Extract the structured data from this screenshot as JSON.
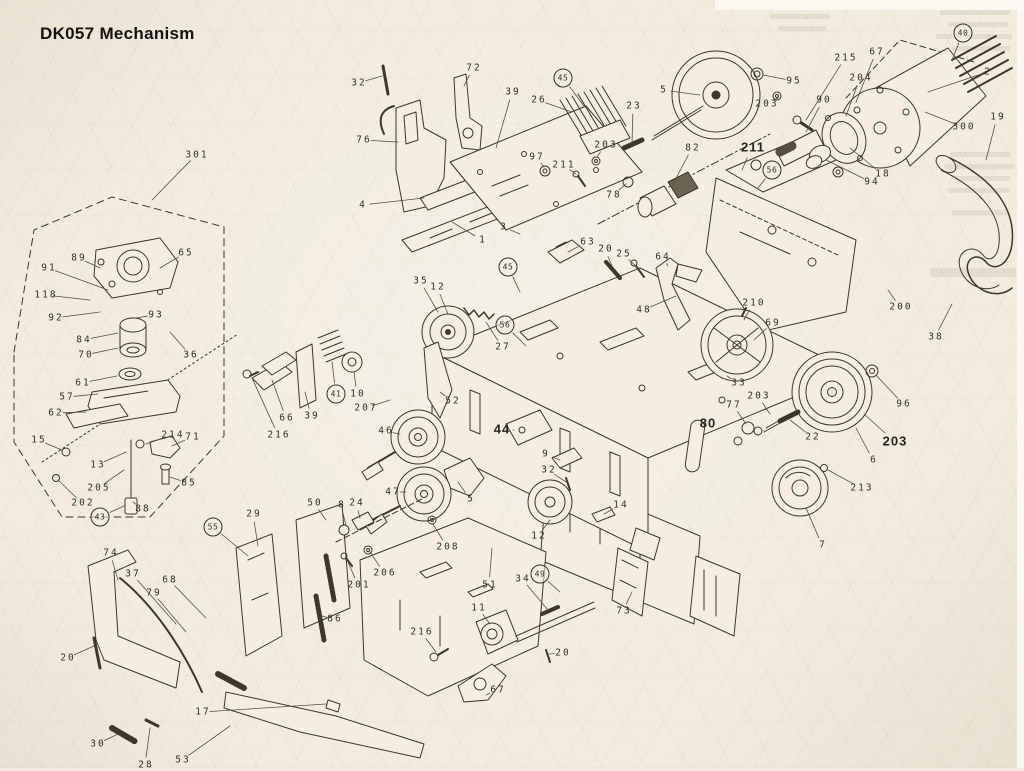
{
  "page": {
    "title": "DK057 Mechanism",
    "background": "#f2ecdf",
    "ink": "#3a342b"
  },
  "diagram": {
    "description": "Exploded parts view of the DK057 tape mechanism with numbered callouts",
    "callouts": [
      {
        "label": "301",
        "x": 196,
        "y": 155,
        "leader": [
          152,
          200
        ]
      },
      {
        "label": "89",
        "x": 78,
        "y": 258,
        "leader": [
          100,
          268
        ]
      },
      {
        "label": "65",
        "x": 185,
        "y": 253,
        "leader": [
          160,
          268
        ]
      },
      {
        "label": "91",
        "x": 48,
        "y": 268,
        "leader": [
          108,
          290
        ]
      },
      {
        "label": "118",
        "x": 45,
        "y": 295,
        "leader": [
          90,
          300
        ]
      },
      {
        "label": "92",
        "x": 55,
        "y": 318,
        "leader": [
          100,
          312
        ]
      },
      {
        "label": "93",
        "x": 155,
        "y": 315,
        "leader": [
          136,
          318
        ]
      },
      {
        "label": "36",
        "x": 190,
        "y": 355,
        "leader": [
          170,
          332
        ]
      },
      {
        "label": "84",
        "x": 83,
        "y": 340,
        "leader": [
          118,
          333
        ]
      },
      {
        "label": "70",
        "x": 85,
        "y": 355,
        "leader": [
          118,
          348
        ]
      },
      {
        "label": "61",
        "x": 82,
        "y": 383,
        "leader": [
          117,
          376
        ]
      },
      {
        "label": "57",
        "x": 66,
        "y": 397,
        "leader": [
          98,
          394
        ]
      },
      {
        "label": "62",
        "x": 55,
        "y": 413,
        "leader": [
          86,
          412
        ]
      },
      {
        "label": "15",
        "x": 38,
        "y": 440,
        "leader": [
          62,
          450
        ]
      },
      {
        "label": "214",
        "x": 172,
        "y": 435,
        "leader": [
          146,
          444
        ]
      },
      {
        "label": "71",
        "x": 192,
        "y": 437,
        "leader": [
          172,
          446
        ]
      },
      {
        "label": "13",
        "x": 97,
        "y": 465,
        "leader": [
          126,
          452
        ]
      },
      {
        "label": "205",
        "x": 98,
        "y": 488,
        "leader": [
          124,
          470
        ]
      },
      {
        "label": "85",
        "x": 188,
        "y": 483,
        "leader": [
          170,
          477
        ]
      },
      {
        "label": "202",
        "x": 82,
        "y": 503,
        "leader": [
          58,
          480
        ]
      },
      {
        "label": "43",
        "x": 100,
        "y": 517,
        "circled": true,
        "leader": [
          124,
          506
        ]
      },
      {
        "label": "88",
        "x": 142,
        "y": 509,
        "leader": [
          133,
          502
        ]
      },
      {
        "label": "74",
        "x": 110,
        "y": 553,
        "leader": [
          118,
          580
        ]
      },
      {
        "label": "37",
        "x": 132,
        "y": 574,
        "leader": [
          176,
          624
        ]
      },
      {
        "label": "79",
        "x": 153,
        "y": 593,
        "leader": [
          186,
          632
        ]
      },
      {
        "label": "68",
        "x": 169,
        "y": 580,
        "leader": [
          206,
          618
        ]
      },
      {
        "label": "20",
        "x": 67,
        "y": 658,
        "leader": [
          94,
          646
        ]
      },
      {
        "label": "30",
        "x": 97,
        "y": 744,
        "leader": [
          118,
          734
        ]
      },
      {
        "label": "28",
        "x": 145,
        "y": 765,
        "leader": [
          150,
          728
        ]
      },
      {
        "label": "53",
        "x": 182,
        "y": 760,
        "leader": [
          230,
          726
        ]
      },
      {
        "label": "17",
        "x": 202,
        "y": 712,
        "leader": [
          326,
          704
        ]
      },
      {
        "label": "55",
        "x": 213,
        "y": 527,
        "circled": true,
        "leader": [
          248,
          556
        ]
      },
      {
        "label": "29",
        "x": 253,
        "y": 514,
        "leader": [
          258,
          546
        ]
      },
      {
        "label": "50",
        "x": 314,
        "y": 503,
        "leader": [
          326,
          520
        ]
      },
      {
        "label": "66",
        "x": 286,
        "y": 418,
        "leader": [
          272,
          380
        ]
      },
      {
        "label": "39",
        "x": 311,
        "y": 416,
        "leader": [
          305,
          392
        ]
      },
      {
        "label": "216",
        "x": 278,
        "y": 435,
        "leader": [
          252,
          378
        ]
      },
      {
        "label": "41",
        "x": 336,
        "y": 394,
        "circled": true,
        "leader": [
          332,
          362
        ]
      },
      {
        "label": "10",
        "x": 357,
        "y": 394,
        "leader": [
          354,
          372
        ]
      },
      {
        "label": "207",
        "x": 365,
        "y": 408,
        "leader": [
          390,
          400
        ]
      },
      {
        "label": "86",
        "x": 334,
        "y": 619,
        "leader": [
          322,
          616
        ]
      },
      {
        "label": "201",
        "x": 358,
        "y": 585,
        "leader": [
          348,
          562
        ]
      },
      {
        "label": "206",
        "x": 384,
        "y": 573,
        "leader": [
          370,
          552
        ]
      },
      {
        "label": "8",
        "x": 341,
        "y": 505,
        "leader": [
          346,
          526
        ]
      },
      {
        "label": "24",
        "x": 356,
        "y": 503,
        "leader": [
          360,
          518
        ]
      },
      {
        "label": "32",
        "x": 358,
        "y": 83,
        "leader": [
          382,
          76
        ]
      },
      {
        "label": "72",
        "x": 473,
        "y": 68,
        "leader": [
          464,
          86
        ]
      },
      {
        "label": "76",
        "x": 363,
        "y": 140,
        "leader": [
          398,
          142
        ]
      },
      {
        "label": "4",
        "x": 362,
        "y": 205,
        "leader": [
          424,
          198
        ]
      },
      {
        "label": "39",
        "x": 512,
        "y": 92,
        "leader": [
          496,
          148
        ]
      },
      {
        "label": "26",
        "x": 538,
        "y": 100,
        "leader": [
          572,
          112
        ]
      },
      {
        "label": "45",
        "x": 563,
        "y": 78,
        "circled": true,
        "leader": [
          584,
          106
        ]
      },
      {
        "label": "97",
        "x": 536,
        "y": 157,
        "leader": [
          544,
          167
        ]
      },
      {
        "label": "211",
        "x": 563,
        "y": 165,
        "leader": [
          576,
          174
        ]
      },
      {
        "label": "203",
        "x": 605,
        "y": 145,
        "leader": [
          597,
          157
        ]
      },
      {
        "label": "23",
        "x": 633,
        "y": 106,
        "leader": [
          632,
          144
        ]
      },
      {
        "label": "78",
        "x": 613,
        "y": 195,
        "leader": [
          626,
          184
        ]
      },
      {
        "label": "1",
        "x": 482,
        "y": 240,
        "leader": [
          452,
          222
        ]
      },
      {
        "label": "3",
        "x": 503,
        "y": 227,
        "leader": [
          520,
          234
        ]
      },
      {
        "label": "5",
        "x": 663,
        "y": 90,
        "leader": [
          700,
          95
        ]
      },
      {
        "label": "95",
        "x": 793,
        "y": 81,
        "leader": [
          763,
          75
        ]
      },
      {
        "label": "203",
        "x": 766,
        "y": 104,
        "leader": [
          778,
          98
        ]
      },
      {
        "label": "90",
        "x": 823,
        "y": 100,
        "leader": [
          806,
          132
        ]
      },
      {
        "label": "82",
        "x": 692,
        "y": 148,
        "leader": [
          672,
          186
        ]
      },
      {
        "label": "211",
        "x": 752,
        "y": 147,
        "bold": true,
        "leader": [
          742,
          170
        ]
      },
      {
        "label": "215",
        "x": 845,
        "y": 58,
        "leader": [
          806,
          120
        ]
      },
      {
        "label": "67",
        "x": 876,
        "y": 52,
        "leader": [
          856,
          102
        ]
      },
      {
        "label": "204",
        "x": 860,
        "y": 78,
        "leader": [
          846,
          116
        ]
      },
      {
        "label": "40",
        "x": 963,
        "y": 33,
        "circled": true,
        "leader": [
          952,
          60
        ]
      },
      {
        "label": "2",
        "x": 987,
        "y": 72,
        "leader": [
          928,
          92
        ]
      },
      {
        "label": "300",
        "x": 963,
        "y": 127,
        "leader": [
          925,
          112
        ]
      },
      {
        "label": "19",
        "x": 997,
        "y": 117,
        "leader": [
          986,
          160
        ]
      },
      {
        "label": "18",
        "x": 882,
        "y": 174,
        "leader": [
          850,
          148
        ]
      },
      {
        "label": "94",
        "x": 871,
        "y": 182,
        "leader": [
          826,
          160
        ]
      },
      {
        "label": "63",
        "x": 587,
        "y": 242,
        "leader": [
          568,
          252
        ]
      },
      {
        "label": "20",
        "x": 605,
        "y": 249,
        "leader": [
          612,
          266
        ]
      },
      {
        "label": "25",
        "x": 623,
        "y": 254,
        "leader": [
          638,
          268
        ]
      },
      {
        "label": "64",
        "x": 662,
        "y": 257,
        "leader": [
          668,
          266
        ]
      },
      {
        "label": "35",
        "x": 420,
        "y": 281,
        "leader": [
          438,
          312
        ]
      },
      {
        "label": "12",
        "x": 437,
        "y": 287,
        "leader": [
          448,
          314
        ]
      },
      {
        "label": "27",
        "x": 502,
        "y": 347,
        "leader": [
          486,
          322
        ]
      },
      {
        "label": "52",
        "x": 452,
        "y": 401,
        "leader": [
          440,
          392
        ]
      },
      {
        "label": "45",
        "x": 508,
        "y": 267,
        "circled": true,
        "leader": [
          520,
          292
        ]
      },
      {
        "label": "56",
        "x": 505,
        "y": 325,
        "circled": true,
        "leader": [
          526,
          346
        ]
      },
      {
        "label": "48",
        "x": 643,
        "y": 310,
        "leader": [
          676,
          296
        ]
      },
      {
        "label": "210",
        "x": 753,
        "y": 303,
        "leader": [
          744,
          320
        ]
      },
      {
        "label": "69",
        "x": 772,
        "y": 323,
        "leader": [
          754,
          340
        ]
      },
      {
        "label": "200",
        "x": 900,
        "y": 307,
        "leader": [
          888,
          290
        ]
      },
      {
        "label": "38",
        "x": 935,
        "y": 337,
        "leader": [
          952,
          304
        ]
      },
      {
        "label": "33",
        "x": 738,
        "y": 383,
        "leader": [
          727,
          376
        ]
      },
      {
        "label": "77",
        "x": 733,
        "y": 405,
        "leader": [
          746,
          424
        ]
      },
      {
        "label": "80",
        "x": 707,
        "y": 423,
        "bold": true
      },
      {
        "label": "203",
        "x": 758,
        "y": 396,
        "leader": [
          770,
          414
        ]
      },
      {
        "label": "22",
        "x": 812,
        "y": 437,
        "leader": [
          790,
          420
        ]
      },
      {
        "label": "96",
        "x": 903,
        "y": 404,
        "leader": [
          876,
          375
        ]
      },
      {
        "label": "203",
        "x": 894,
        "y": 441,
        "bold": true,
        "leader": [
          864,
          414
        ]
      },
      {
        "label": "6",
        "x": 873,
        "y": 460,
        "leader": [
          856,
          428
        ]
      },
      {
        "label": "213",
        "x": 861,
        "y": 488,
        "leader": [
          828,
          470
        ]
      },
      {
        "label": "7",
        "x": 822,
        "y": 545,
        "leader": [
          806,
          508
        ]
      },
      {
        "label": "56",
        "x": 772,
        "y": 170,
        "circled": true,
        "leader": [
          758,
          188
        ]
      },
      {
        "label": "46",
        "x": 385,
        "y": 431,
        "leader": [
          400,
          434
        ]
      },
      {
        "label": "47",
        "x": 392,
        "y": 492,
        "leader": [
          406,
          492
        ]
      },
      {
        "label": "44",
        "x": 501,
        "y": 429,
        "bold": true,
        "leader": [
          514,
          430
        ]
      },
      {
        "label": "9",
        "x": 545,
        "y": 454,
        "leader": [
          560,
          460
        ]
      },
      {
        "label": "32",
        "x": 548,
        "y": 470,
        "leader": [
          566,
          482
        ]
      },
      {
        "label": "12",
        "x": 538,
        "y": 536,
        "leader": [
          550,
          520
        ]
      },
      {
        "label": "14",
        "x": 620,
        "y": 505,
        "leader": [
          604,
          514
        ]
      },
      {
        "label": "51",
        "x": 489,
        "y": 585,
        "leader": [
          492,
          548
        ]
      },
      {
        "label": "34",
        "x": 522,
        "y": 579,
        "leader": [
          548,
          610
        ]
      },
      {
        "label": "49",
        "x": 540,
        "y": 574,
        "circled": true,
        "leader": [
          560,
          592
        ]
      },
      {
        "label": "73",
        "x": 623,
        "y": 611,
        "leader": [
          632,
          592
        ]
      },
      {
        "label": "11",
        "x": 478,
        "y": 608,
        "leader": [
          490,
          624
        ]
      },
      {
        "label": "216",
        "x": 421,
        "y": 632,
        "leader": [
          436,
          652
        ]
      },
      {
        "label": "208",
        "x": 447,
        "y": 547,
        "leader": [
          433,
          524
        ]
      },
      {
        "label": "5",
        "x": 470,
        "y": 499,
        "leader": [
          458,
          482
        ]
      },
      {
        "label": "67",
        "x": 497,
        "y": 690,
        "leader": [
          486,
          695
        ]
      },
      {
        "label": "20",
        "x": 562,
        "y": 653,
        "leader": [
          549,
          654
        ]
      }
    ]
  }
}
